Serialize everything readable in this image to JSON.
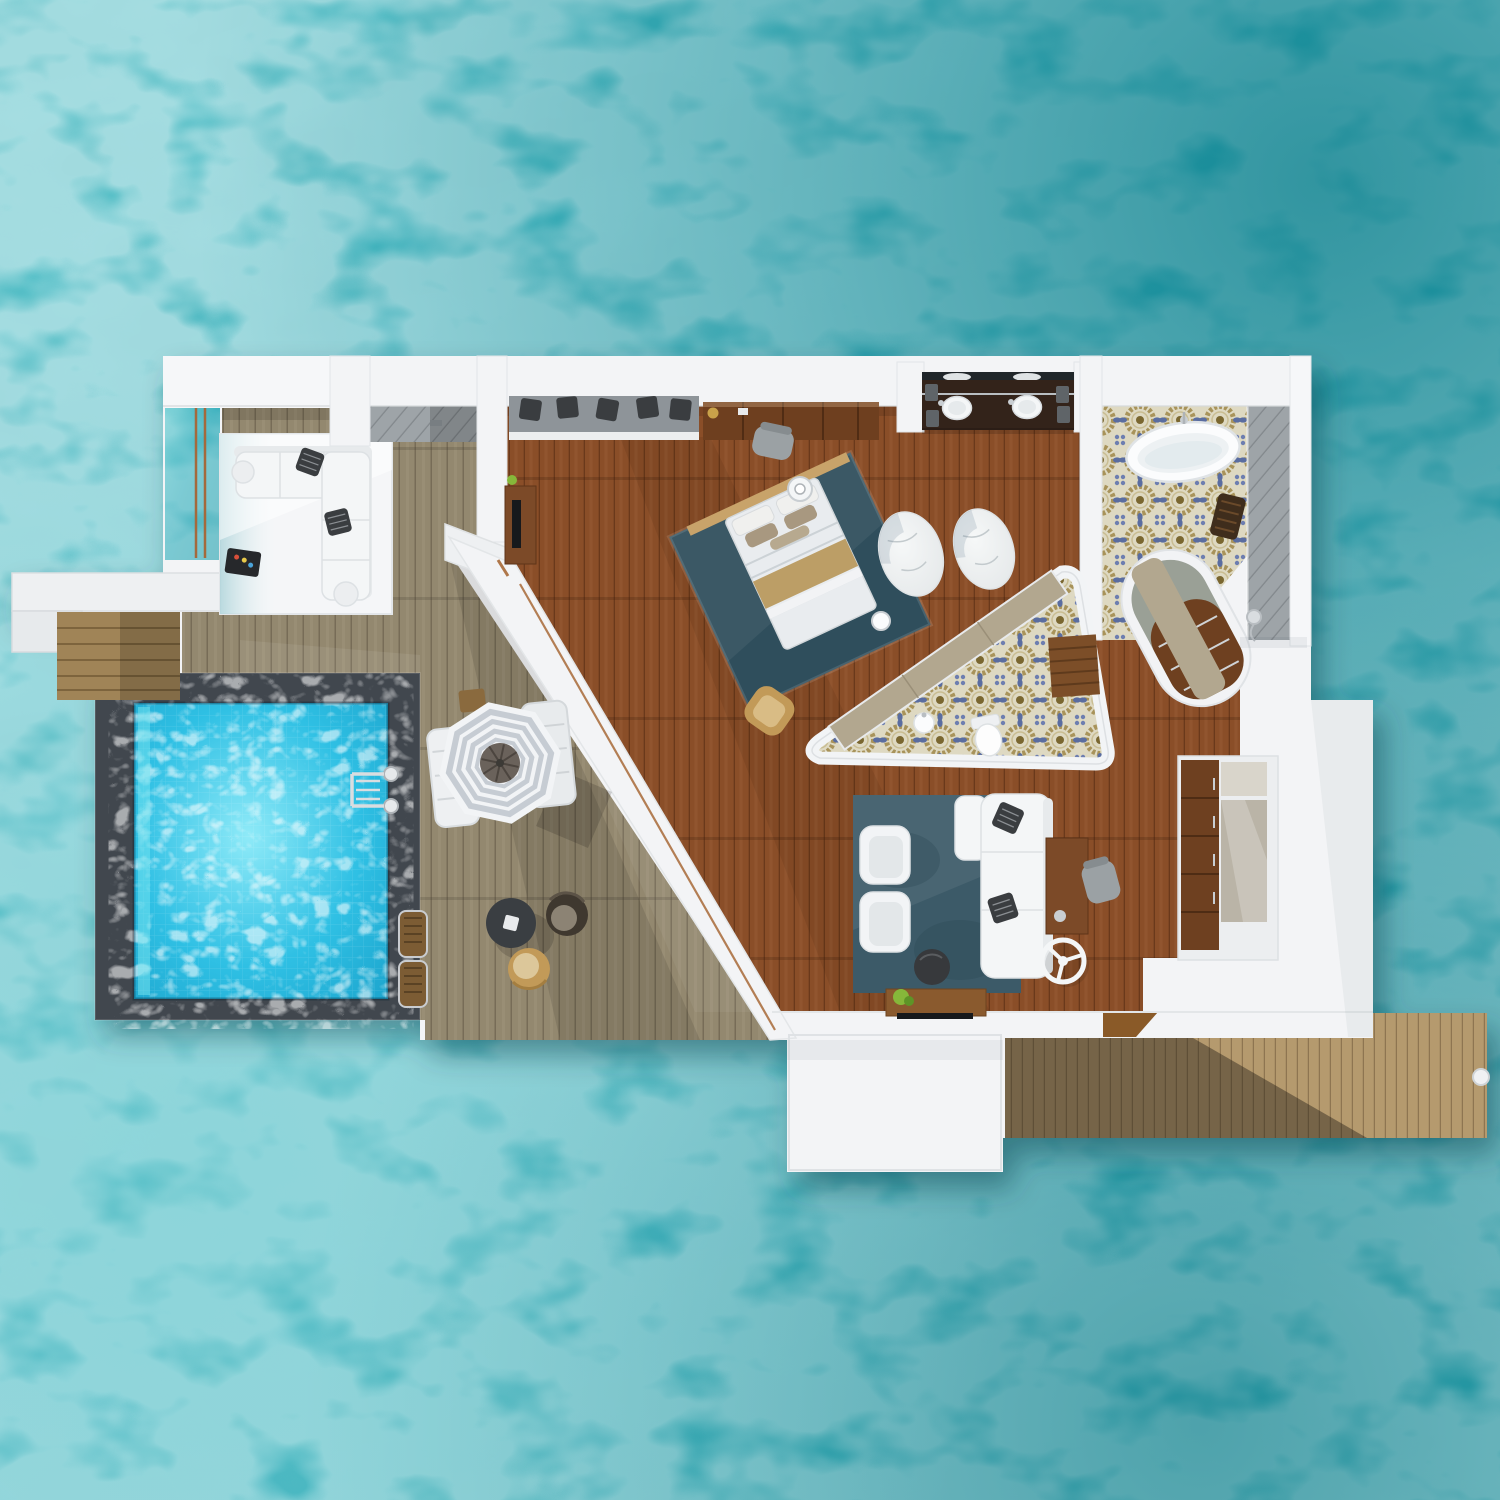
{
  "title": "Overwater villa floor plan - aerial 3D render",
  "scene": {
    "setting": "turquoise tropical lagoon, top-down aerial view",
    "structure": "overwater villa with private pool, sun deck, water lounge and jetty",
    "rooms": [
      {
        "name": "water-lounge",
        "items": [
          "l-shaped-sectional-sofa",
          "throw-pillows",
          "speaker-tray",
          "overwater-platform",
          "rope-rails"
        ]
      },
      {
        "name": "outdoor-shower",
        "items": [
          "rain-shower-head",
          "teak-floor"
        ]
      },
      {
        "name": "sun-deck",
        "items": [
          "striped-parasol",
          "sun-loungers",
          "side-table",
          "round-table",
          "wicker-chair-dark",
          "wicker-chair-tan",
          "step-mats"
        ]
      },
      {
        "name": "private-pool",
        "items": [
          "stone-coping",
          "chrome-ladder"
        ]
      },
      {
        "name": "bedroom",
        "items": [
          "king-bed",
          "headboard",
          "gold-runner",
          "area-rug",
          "bedside-trays",
          "tan-armchair",
          "media-desk",
          "wall-dresser",
          "vanity-chair",
          "oval-marble-rugs"
        ]
      },
      {
        "name": "walk-in-closet",
        "items": [
          "bench-cushion",
          "accent-pillows"
        ]
      },
      {
        "name": "bathroom",
        "items": [
          "freestanding-bathtub",
          "double-vanity",
          "twin-sinks",
          "towel-stacks",
          "shower-strip",
          "teak-stool",
          "hand-shower",
          "curved-closet-island"
        ]
      },
      {
        "name": "powder-room",
        "items": [
          "toilet",
          "washbasin",
          "teak-bench",
          "curved-counter",
          "patterned-tile-floor"
        ]
      },
      {
        "name": "living-room",
        "items": [
          "white-sofa",
          "armchairs",
          "round-pouf",
          "writing-desk",
          "desk-chair",
          "ceiling-fan",
          "tv-console",
          "green-plant"
        ]
      },
      {
        "name": "kitchenette",
        "items": [
          "tall-wood-cabinet",
          "stone-counter"
        ]
      },
      {
        "name": "jetty",
        "items": [
          "timber-walkway",
          "mooring-bollard"
        ]
      }
    ]
  },
  "palette": {
    "ocean_base": "#35aebc",
    "ocean_deep": "#0e7f8c",
    "ocean_mid": "#2aa2af",
    "ocean_pale": "#55c4cb",
    "pool_water": "#2fc0e4",
    "pool_light": "#8feaf8",
    "pool_border": "#41474e",
    "white_structure": "#f3f4f6",
    "deck_wood": "#93886f",
    "interior_wood": "#8a4e28",
    "walkway_wood": "#b59a6e",
    "step_wood": "#a08457",
    "threshold_wood": "#8a5a28",
    "rug_platform": "#f5f6f8",
    "sofa_white": "#f4f6f7",
    "pillow_dark": "#3a3d40",
    "bed_rug": "#2f4e5c",
    "living_rug": "#3c5a68",
    "bed_white": "#e9ecef",
    "bed_gold": "#b99a5e",
    "headboard_wood": "#c8a36a",
    "pillow_taupe": "#a89880",
    "marble_white": "#eceff0",
    "tile_bg": "#ded9c2",
    "tile_gold": "#a8935a",
    "tile_blue": "#5a6da0",
    "tile_brown": "#7a6730",
    "counter_taupe": "#b2a78f",
    "island_gray": "#9aa096",
    "cabinet_wood": "#6e4020",
    "dresser_wood": "#6e3f1f",
    "vanity_wood": "#33231a",
    "bench_cushion": "#8e9499",
    "shower_gray": "#9ea4a8",
    "chair_gray": "#9ba1a4",
    "chair_tan": "#c29a58",
    "chair_dark": "#3f382f",
    "umbrella_white": "#f2f4f6",
    "umbrella_stripe": "#c6ccd3",
    "umbrella_center": "#6a625b",
    "table_dark": "#3a3e42",
    "stool_wood": "#3f2d1c",
    "tub_white": "#fbfcfd",
    "toilet_white": "#fdfdfd",
    "chrome": "#c9ced2",
    "rope": "#a4693c",
    "tv_dark": "#17191c",
    "plant_green": "#86b83a"
  }
}
